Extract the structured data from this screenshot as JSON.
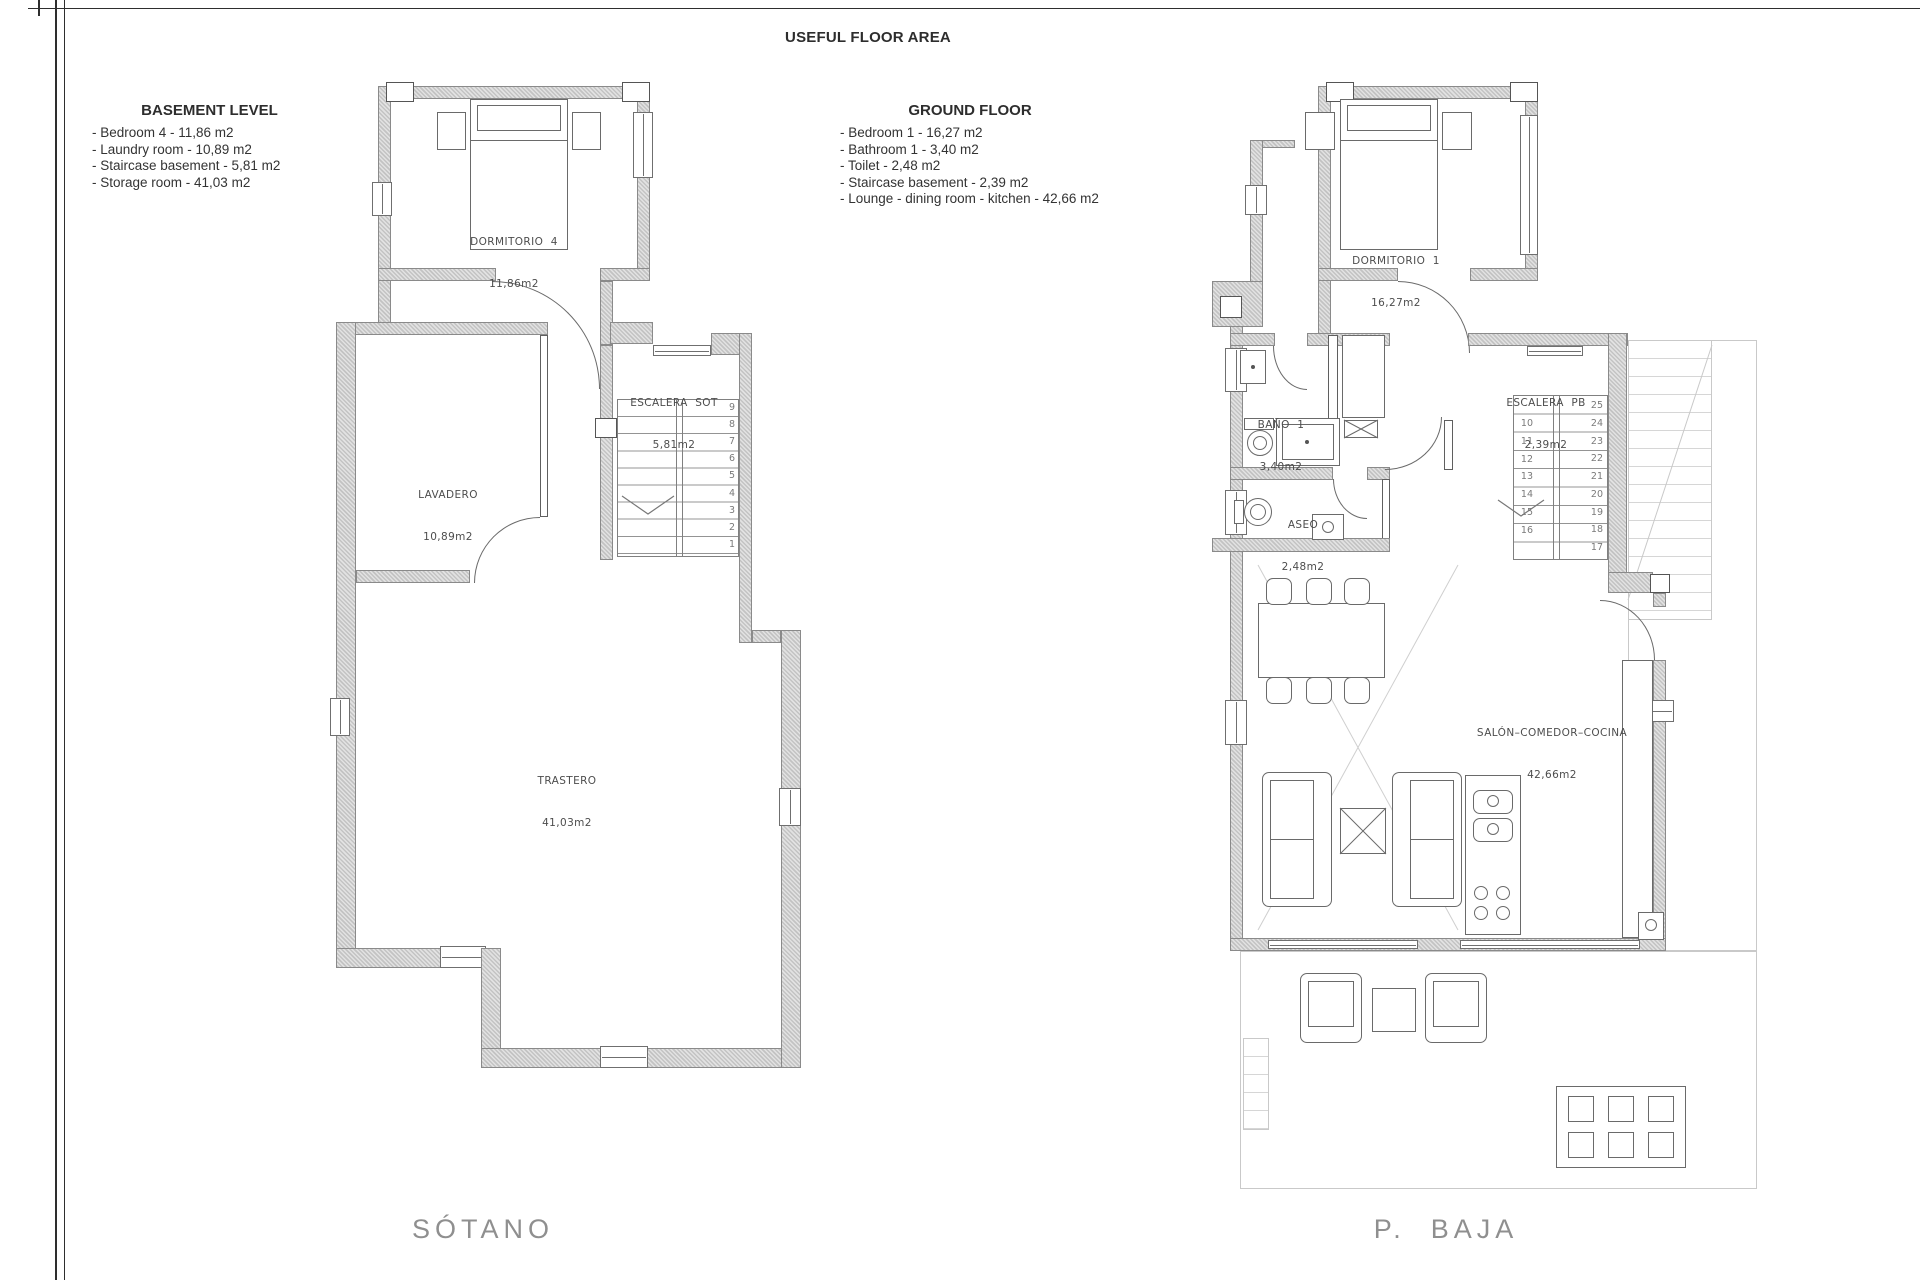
{
  "title": "USEFUL FLOOR AREA",
  "legend": {
    "basement": {
      "heading": "BASEMENT LEVEL",
      "items": [
        "- Bedroom 4 - 11,86 m2",
        "- Laundry room - 10,89 m2",
        "- Staircase basement - 5,81 m2",
        "- Storage room - 41,03 m2"
      ]
    },
    "ground": {
      "heading": "GROUND FLOOR",
      "items": [
        "- Bedroom 1 - 16,27 m2",
        "- Bathroom 1 - 3,40 m2",
        "- Toilet - 2,48 m2",
        "- Staircase basement - 2,39 m2",
        "- Lounge - dining room - kitchen - 42,66 m2"
      ]
    }
  },
  "plans": {
    "sotano": {
      "caption": "SÓTANO",
      "rooms": {
        "dormitorio4": {
          "name": "DORMITORIO  4",
          "area": "11,86m2"
        },
        "lavadero": {
          "name": "LAVADERO",
          "area": "10,89m2"
        },
        "escalera": {
          "name": "ESCALERA  SOT",
          "area": "5,81m2"
        },
        "trastero": {
          "name": "TRASTERO",
          "area": "41,03m2"
        }
      },
      "stair_numbers": [
        "9",
        "8",
        "7",
        "6",
        "5",
        "4",
        "3",
        "2",
        "1"
      ]
    },
    "pbaja": {
      "caption": "P.  BAJA",
      "rooms": {
        "dormitorio1": {
          "name": "DORMITORIO  1",
          "area": "16,27m2"
        },
        "bano": {
          "name": "BAÑO  1",
          "area": "3,40m2"
        },
        "aseo": {
          "name": "ASEO",
          "area": "2,48m2"
        },
        "escalera": {
          "name": "ESCALERA  PB",
          "area": "2,39m2"
        },
        "salon": {
          "name": "SALÓN–COMEDOR–COCINA",
          "area": "42,66m2"
        }
      },
      "stair_numbers_left": [
        "10",
        "11",
        "12",
        "13",
        "14",
        "15",
        "16"
      ],
      "stair_numbers_right": [
        "25",
        "24",
        "23",
        "22",
        "21",
        "20",
        "19",
        "18",
        "17"
      ]
    }
  },
  "colors": {
    "wall_fill": "#d6d6d6",
    "wall_edge": "#8a8a8a",
    "line": "#6a6a6a",
    "light_line": "#c9c9c9"
  }
}
